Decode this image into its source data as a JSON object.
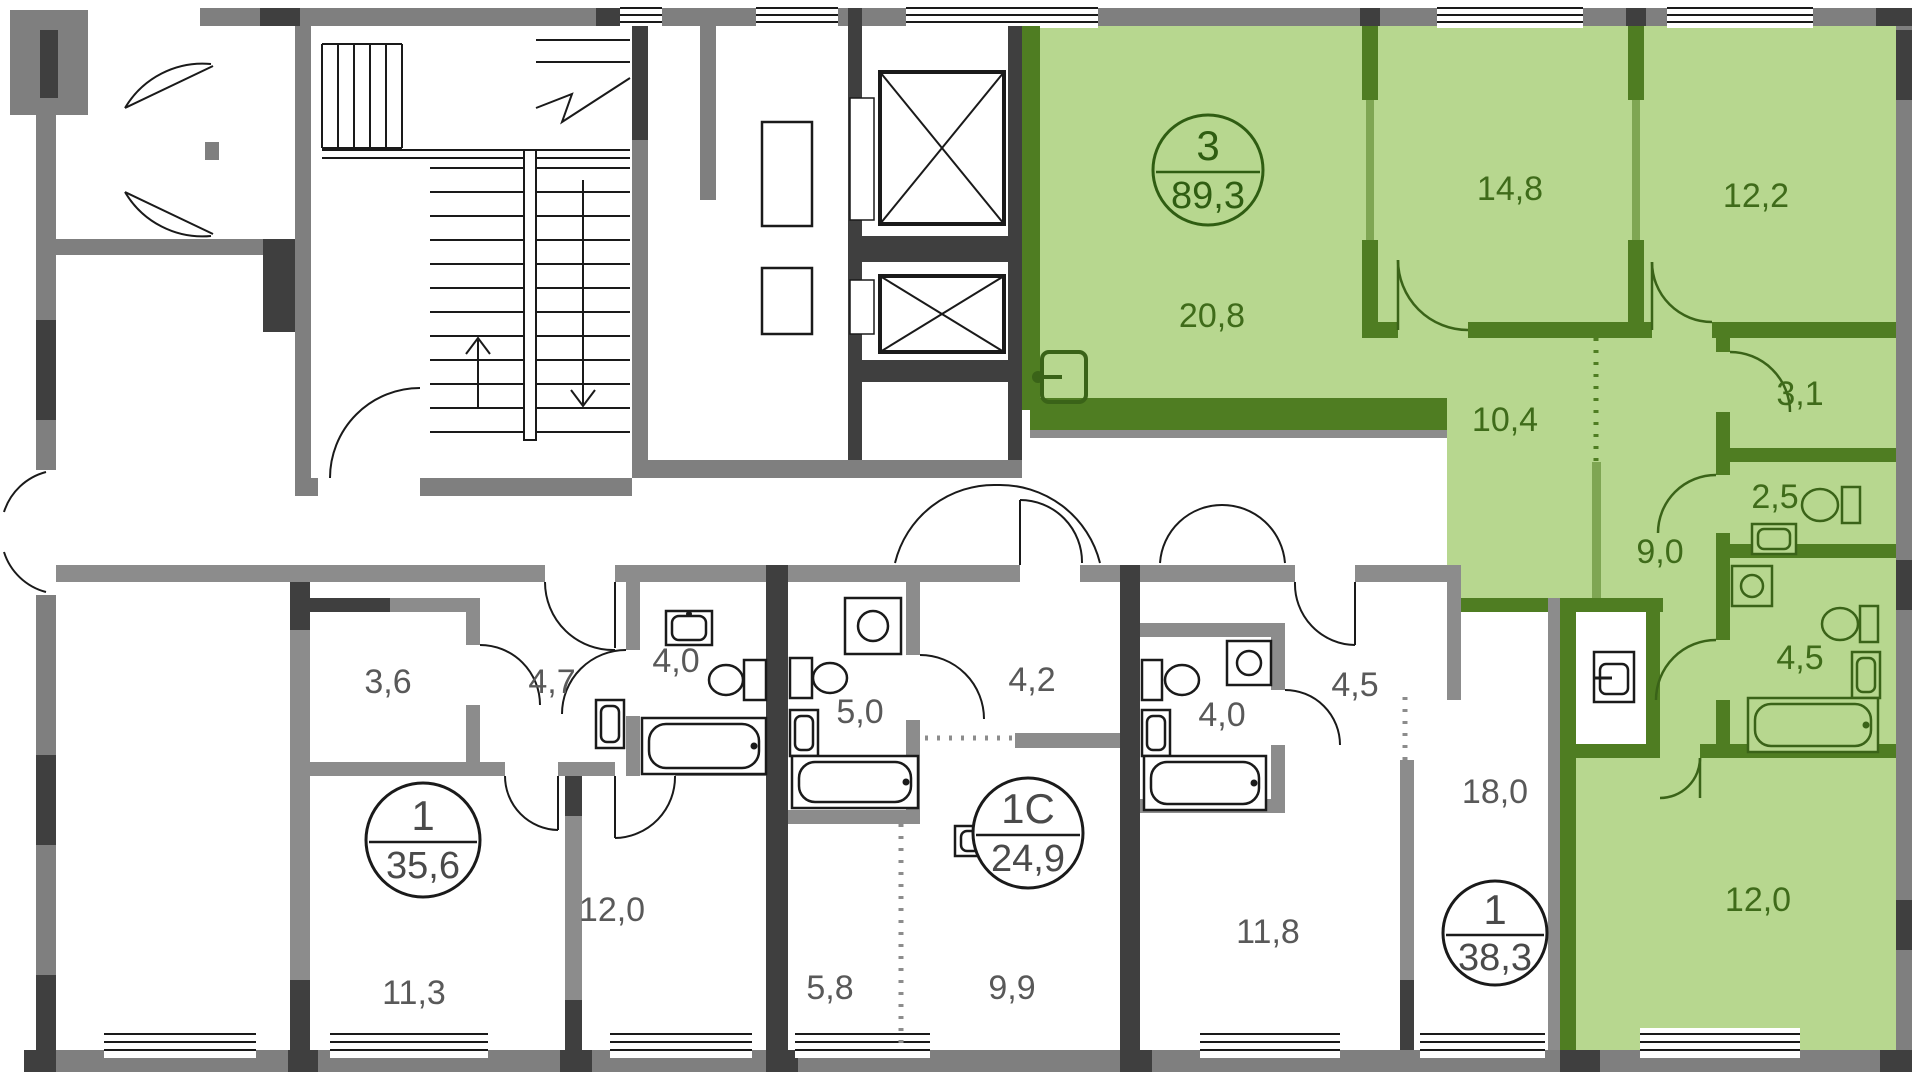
{
  "plan": {
    "colors": {
      "wall_gray": "#7f7f7f",
      "wall_dark": "#3f3f3f",
      "wall_inner": "#8c8c8c",
      "green_fill": "#b7d78f",
      "green_wall": "#4f7d22",
      "label_gray": "#595959",
      "label_green": "#3f6b1a"
    },
    "apartments": [
      {
        "id": "apt-3-rooms-89-3",
        "circle": {
          "type": "3",
          "area": "89,3"
        },
        "rooms": [
          {
            "name": "kitchen-living",
            "area": "20,8"
          },
          {
            "name": "bedroom-1",
            "area": "14,8"
          },
          {
            "name": "bedroom-2",
            "area": "12,2"
          },
          {
            "name": "hall",
            "area": "10,4"
          },
          {
            "name": "wardrobe",
            "area": "3,1"
          },
          {
            "name": "wc",
            "area": "2,5"
          },
          {
            "name": "corridor",
            "area": "9,0"
          },
          {
            "name": "bathroom",
            "area": "4,5"
          },
          {
            "name": "bedroom-3",
            "area": "12,0"
          }
        ]
      },
      {
        "id": "apt-1-room-35-6",
        "circle": {
          "type": "1",
          "area": "35,6"
        },
        "rooms": [
          {
            "name": "hall",
            "area": "3,6"
          },
          {
            "name": "corridor",
            "area": "4,7"
          },
          {
            "name": "bathroom",
            "area": "4,0"
          },
          {
            "name": "kitchen",
            "area": "12,0"
          },
          {
            "name": "room",
            "area": "11,3"
          }
        ]
      },
      {
        "id": "apt-1c-studio-24-9",
        "circle": {
          "type": "1С",
          "area": "24,9"
        },
        "rooms": [
          {
            "name": "hall",
            "area": "4,2"
          },
          {
            "name": "bathroom",
            "area": "5,0"
          },
          {
            "name": "kitchen-niche",
            "area": "5,8"
          },
          {
            "name": "living",
            "area": "9,9"
          }
        ]
      },
      {
        "id": "apt-1-room-38-3",
        "circle": {
          "type": "1",
          "area": "38,3"
        },
        "rooms": [
          {
            "name": "hall",
            "area": "4,5"
          },
          {
            "name": "bathroom",
            "area": "4,0"
          },
          {
            "name": "kitchen",
            "area": "11,8"
          },
          {
            "name": "living",
            "area": "18,0"
          }
        ]
      }
    ]
  }
}
